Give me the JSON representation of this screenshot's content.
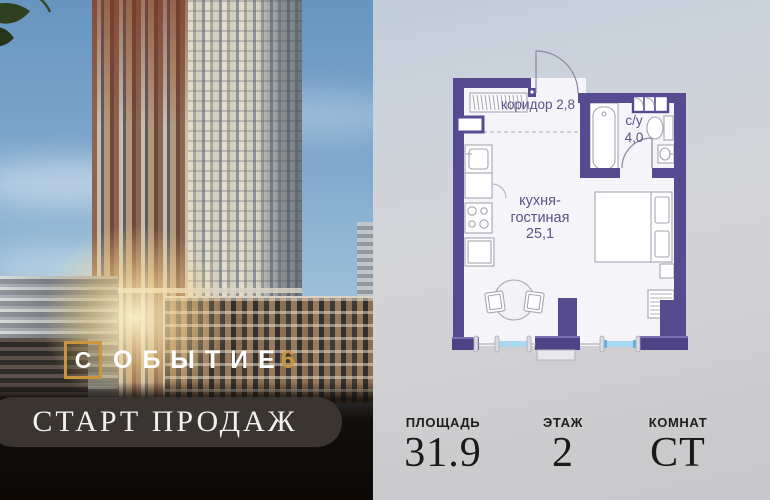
{
  "left_panel": {
    "logo": {
      "boxed_letter": "С",
      "word_rest": "ОБЫТИЕ",
      "number": "6"
    },
    "banner": {
      "text": "СТАРТ ПРОДАЖ"
    }
  },
  "floorplan": {
    "rooms": [
      {
        "name": "коридор",
        "area": "2,8"
      },
      {
        "name": "с/у",
        "area": "4,0"
      },
      {
        "name": "кухня-гостиная",
        "area": "25,1"
      }
    ],
    "colors": {
      "wall": "#564a90",
      "window": "#a7daf2",
      "label_text": "#5b5387"
    }
  },
  "stats": [
    {
      "label": "ПЛОЩАДЬ",
      "value": "31.9"
    },
    {
      "label": "ЭТАЖ",
      "value": "2"
    },
    {
      "label": "КОМНАТ",
      "value": "СТ"
    }
  ],
  "brand": {
    "accent_gold": "#c9963f",
    "banner_bg": "#3a3531"
  }
}
